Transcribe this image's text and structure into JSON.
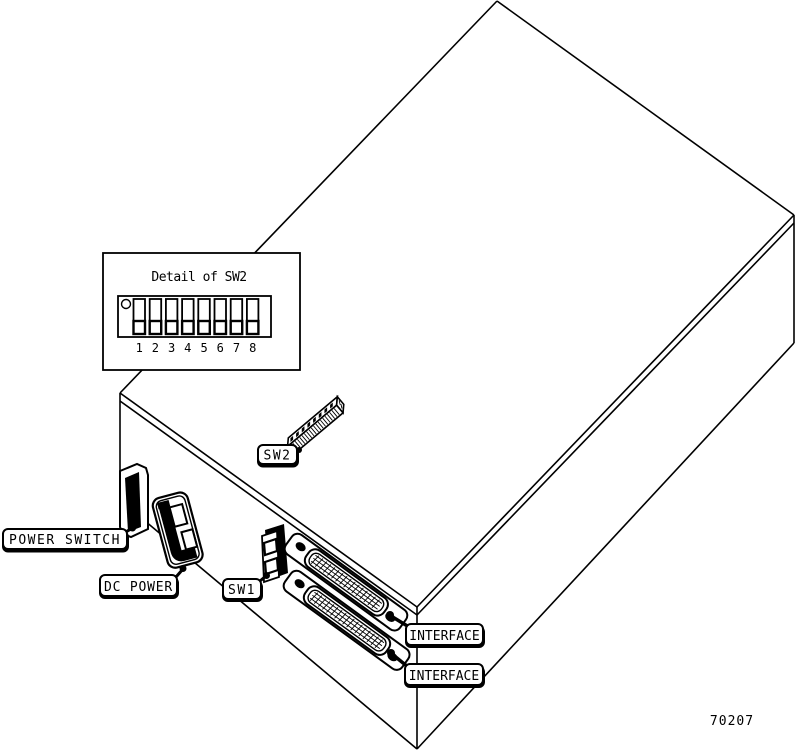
{
  "figure": {
    "number": "70207"
  },
  "detail_panel": {
    "title": "Detail of SW2",
    "switch_numbers": [
      "1",
      "2",
      "3",
      "4",
      "5",
      "6",
      "7",
      "8"
    ],
    "switch_count": 8,
    "switch_positions": "all down"
  },
  "labels": {
    "power_switch": "POWER SWITCH",
    "dc_power": "DC POWER",
    "sw1": "SW1",
    "sw2": "SW2",
    "interface_top": "INTERFACE",
    "interface_bottom": "INTERFACE"
  },
  "colors": {
    "line": "#000000",
    "background": "#ffffff"
  }
}
